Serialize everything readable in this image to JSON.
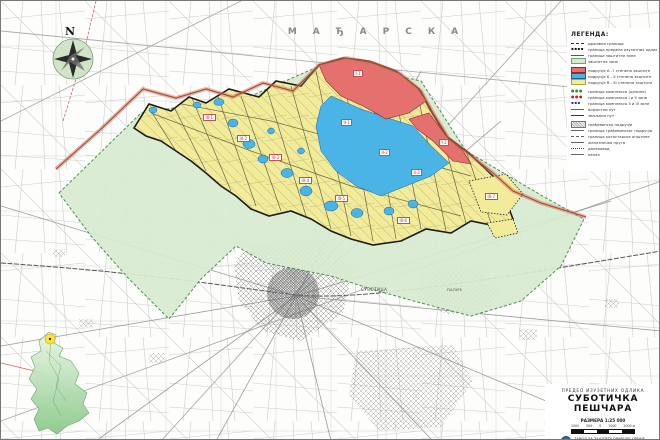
{
  "map": {
    "country_label": "МАЂАРСКА",
    "compass_letter": "N",
    "city_labels": [
      {
        "text": "СУБОТИЦА"
      },
      {
        "text": "ПАЛИЋ"
      }
    ]
  },
  "legend": {
    "title": "ЛЕГЕНДА:",
    "items": [
      {
        "label": "државна граница",
        "symbol": "dashed-line"
      },
      {
        "label": "граница предела изузетних одлика",
        "symbol": "black-squares"
      },
      {
        "label": "граница заштитне зоне",
        "symbol": "solid-line"
      },
      {
        "label": "заштитна зона",
        "symbol": "green-chip"
      },
      {
        "label": "подручје А - I степена заштите",
        "symbol": "red-chip"
      },
      {
        "label": "подручје Б - II степена заштите",
        "symbol": "blue-chip"
      },
      {
        "label": "подручје В - III степена заштите",
        "symbol": "yellow-chip"
      },
      {
        "label": "граница комплекса (целине)",
        "symbol": "green-dots"
      },
      {
        "label": "граница комплекса I и II зоне",
        "symbol": "red-dots"
      },
      {
        "label": "граница комплекса II и III зоне",
        "symbol": "blue-squares"
      },
      {
        "label": "асфалтни пут",
        "symbol": "red-line"
      },
      {
        "label": "земљани пут",
        "symbol": "dark-red-line"
      },
      {
        "label": "грађевинско подручје",
        "symbol": "gray-hatch"
      },
      {
        "label": "граница грађевинског подручја",
        "symbol": "thin-line"
      },
      {
        "label": "граница катастарске општине",
        "symbol": "thin-dashed-line"
      },
      {
        "label": "железничка пруга",
        "symbol": "thin-line"
      },
      {
        "label": "далековод",
        "symbol": "thin-dotted-line"
      },
      {
        "label": "канал",
        "symbol": "thin-line"
      }
    ]
  },
  "zone_labels": [
    {
      "text": "I-1"
    },
    {
      "text": "I-2"
    },
    {
      "text": "II-1"
    },
    {
      "text": "II-2"
    },
    {
      "text": "II-3"
    },
    {
      "text": "III-1"
    },
    {
      "text": "III-2"
    },
    {
      "text": "III-3"
    },
    {
      "text": "III-4"
    },
    {
      "text": "III-5"
    },
    {
      "text": "III-6"
    },
    {
      "text": "III-7"
    }
  ],
  "title_block": {
    "subtitle": "ПРЕДЕО ИЗУЗЕТНИХ ОДЛИКА",
    "title": "СУБОТИЧКА ПЕШЧАРА",
    "scale_text": "РАЗМЕРА 1:25 000",
    "scale_ticks": [
      "1000",
      "500",
      "0",
      "1000",
      "2000 м"
    ],
    "publisher": "ЗАВОД ЗА ЗАШТИТУ ПРИРОДЕ СРБИЈЕ",
    "edition": "Нови Сад, 2003. год."
  },
  "colors": {
    "zone_1_red": "#e4716e",
    "zone_2_blue": "#4ab4e6",
    "zone_3_yellow": "#f2ec9a",
    "buffer_green": "#d8ead0",
    "state_border": "#a34a35",
    "base_lines": "#c6c6c6",
    "inset_green": "#8cc98c",
    "inset_marker_yellow": "#ffe23e"
  }
}
